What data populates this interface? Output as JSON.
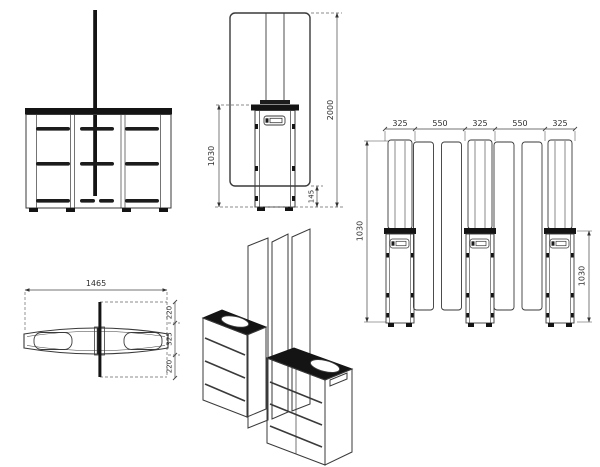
{
  "drawing": {
    "kind": "turnstile speed-gate technical drawing, 5 orthographic/perspective views",
    "colors": {
      "line": "#3a3a3a",
      "dark_fill": "#141414",
      "dim_text": "#2e2e2e",
      "background": "#ffffff"
    },
    "side_view": {
      "total_height": "2000",
      "cabinet_height": "1030",
      "panel_floor_gap": "145"
    },
    "array_view": {
      "segment_widths": [
        "325",
        "550",
        "325",
        "550",
        "325"
      ],
      "left_height": "1030",
      "right_height": "1030"
    },
    "plan_view": {
      "total_width": "1465",
      "depth_top": "220",
      "depth_mid": "325",
      "depth_bottom": "220"
    }
  }
}
